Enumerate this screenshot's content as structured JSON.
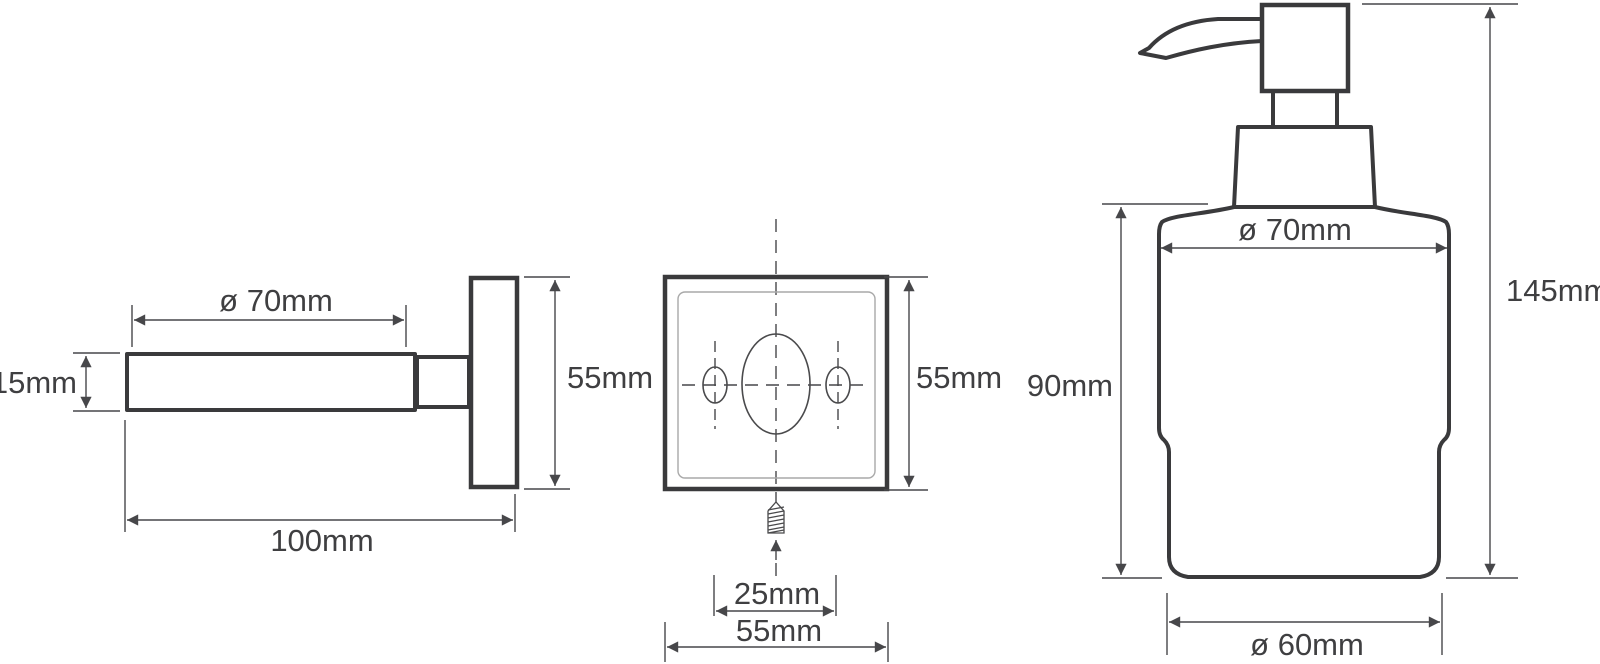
{
  "diagram": {
    "type": "technical-dimension-drawing",
    "subject": "wall-mounted soap dispenser",
    "colors": {
      "background": "#ffffff",
      "outline": "#3a3a3c",
      "dimension_lines": "#47474a",
      "text": "#3f3f41",
      "inner_panel_line": "#a9a9a9"
    },
    "views": {
      "bracket_side": {
        "name": "holder side view",
        "labels": {
          "arm_diameter": "ø 70mm",
          "arm_thickness": "15mm",
          "plate_height": "55mm",
          "total_depth": "100mm"
        }
      },
      "plate_front": {
        "name": "wall plate front view",
        "labels": {
          "plate_height": "55mm",
          "screw_offset": "25mm",
          "plate_width": "55mm"
        }
      },
      "dispenser_front": {
        "name": "dispenser front view",
        "labels": {
          "body_diameter": "ø 70mm",
          "body_height": "90mm",
          "total_height": "145mm",
          "base_diameter": "ø 60mm"
        }
      }
    }
  }
}
